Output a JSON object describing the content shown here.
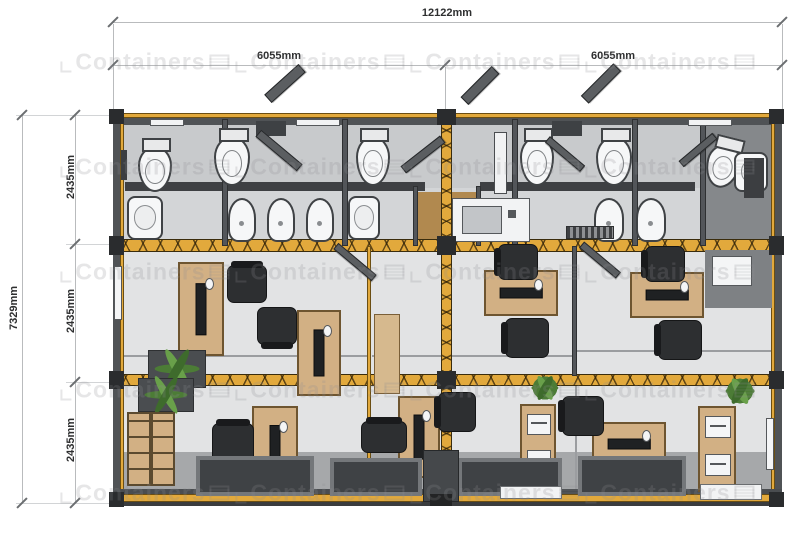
{
  "title": "Container office floor plan",
  "dimensions": {
    "total_width": "12122mm",
    "left_half_width": "6055mm",
    "right_half_width": "6055mm",
    "total_depth": "7329mm",
    "module_depths": [
      "2435mm",
      "2435mm",
      "2435mm"
    ]
  },
  "watermark": {
    "text": "Containers",
    "rows": [
      62,
      167,
      272,
      390,
      493
    ],
    "cols": [
      145,
      320,
      495,
      670
    ]
  },
  "colors": {
    "accent_yellow": "#E2A93C",
    "wall_dark": "#53565A",
    "floor_bath": "#C8CACC",
    "floor_office": "#E2E3E4",
    "walkway_gray": "#A6A8AA",
    "desk_wood": "#D2B084",
    "chair_dark": "#2D2F31",
    "plant_green": "#4C7C36",
    "fixture_white": "#F6F7F8"
  },
  "plan": {
    "items": [
      {
        "t": "rect",
        "n": "floor-bathrooms",
        "x": 119,
        "y": 119,
        "w": 656,
        "h": 127,
        "c": "#C8CACC"
      },
      {
        "t": "rect",
        "n": "floor-bath-corridor",
        "x": 119,
        "y": 188,
        "w": 656,
        "h": 58,
        "c": "#D3D5D7"
      },
      {
        "t": "rect",
        "n": "floor-office-middle",
        "x": 119,
        "y": 246,
        "w": 656,
        "h": 134,
        "c": "#E2E3E4"
      },
      {
        "t": "rect",
        "n": "floor-office-bottom",
        "x": 119,
        "y": 380,
        "w": 656,
        "h": 118,
        "c": "#E2E3E4"
      },
      {
        "t": "rect",
        "n": "floor-walkway",
        "x": 119,
        "y": 452,
        "w": 656,
        "h": 46,
        "c": "#A6A8AA"
      },
      {
        "t": "rect",
        "n": "floor-room-right-dark",
        "x": 703,
        "y": 124,
        "w": 70,
        "h": 116,
        "c": "#85888B"
      },
      {
        "t": "rect",
        "n": "floor-vestibule-wood",
        "x": 416,
        "y": 192,
        "w": 62,
        "h": 54,
        "c": "#B1894F"
      },
      {
        "t": "rect",
        "n": "stall-wall-left",
        "x": 125,
        "y": 182,
        "w": 300,
        "h": 9,
        "c": "#3E4043"
      },
      {
        "t": "rect",
        "n": "stall-wall-right",
        "x": 480,
        "y": 182,
        "w": 215,
        "h": 9,
        "c": "#3E4043"
      },
      {
        "t": "line",
        "n": "glass-line-left",
        "x": 122,
        "y": 355,
        "w": 245,
        "h": 2,
        "c": "#9B9DA0"
      },
      {
        "t": "line",
        "n": "glass-line-center",
        "x": 372,
        "y": 355,
        "w": 200,
        "h": 2,
        "c": "#9B9DA0"
      },
      {
        "t": "line",
        "n": "glass-line-right",
        "x": 577,
        "y": 350,
        "w": 195,
        "h": 2,
        "c": "#9B9DA0"
      },
      {
        "t": "line",
        "n": "glass-line-bottom",
        "x": 575,
        "y": 380,
        "w": 2,
        "h": 116,
        "c": "#9B9DA0"
      },
      {
        "t": "rect",
        "n": "wall-top",
        "x": 113,
        "y": 113,
        "w": 669,
        "h": 12,
        "c": "#505356"
      },
      {
        "t": "yband",
        "n": "frame-top",
        "x": 113,
        "y": 113,
        "w": 669,
        "h": 5
      },
      {
        "t": "rect",
        "n": "wall-left",
        "x": 113,
        "y": 113,
        "w": 7,
        "h": 393,
        "c": "#505356"
      },
      {
        "t": "yband",
        "n": "frame-left",
        "x": 120,
        "y": 118,
        "w": 4,
        "h": 383
      },
      {
        "t": "yband",
        "n": "frame-right",
        "x": 771,
        "y": 118,
        "w": 4,
        "h": 383
      },
      {
        "t": "rect",
        "n": "wall-right",
        "x": 775,
        "y": 113,
        "w": 7,
        "h": 393,
        "c": "#505356"
      },
      {
        "t": "rect",
        "n": "wall-bottom-line",
        "x": 113,
        "y": 489,
        "w": 669,
        "h": 5,
        "c": "#4A4D50"
      },
      {
        "t": "yband",
        "n": "frame-bottom",
        "x": 113,
        "y": 494,
        "w": 669,
        "h": 8
      },
      {
        "t": "rect",
        "n": "wall-bottom-base",
        "x": 113,
        "y": 502,
        "w": 669,
        "h": 4,
        "c": "#3A3C3E"
      },
      {
        "t": "beam",
        "n": "joint-beam-upper",
        "x": 113,
        "y": 239,
        "w": 669,
        "h": 13
      },
      {
        "t": "beam",
        "n": "joint-beam-lower",
        "x": 113,
        "y": 374,
        "w": 669,
        "h": 12
      },
      {
        "t": "beamv",
        "n": "joint-post-center",
        "x": 441,
        "y": 113,
        "w": 11,
        "h": 393
      },
      {
        "t": "wallv",
        "n": "partition-bath-1",
        "x": 222,
        "y": 119,
        "w": 6,
        "h": 127
      },
      {
        "t": "wallv",
        "n": "partition-bath-2",
        "x": 342,
        "y": 119,
        "w": 6,
        "h": 127
      },
      {
        "t": "wallv",
        "n": "partition-bath-3",
        "x": 512,
        "y": 119,
        "w": 6,
        "h": 127
      },
      {
        "t": "wallv",
        "n": "partition-bath-4",
        "x": 632,
        "y": 119,
        "w": 6,
        "h": 127
      },
      {
        "t": "wallv",
        "n": "partition-bath-5",
        "x": 700,
        "y": 119,
        "w": 6,
        "h": 127
      },
      {
        "t": "wallv",
        "n": "vestibule-wall-left",
        "x": 413,
        "y": 186,
        "w": 5,
        "h": 60
      },
      {
        "t": "wallv",
        "n": "vestibule-wall-right",
        "x": 476,
        "y": 186,
        "w": 5,
        "h": 60
      },
      {
        "t": "yband",
        "n": "partition-office-left",
        "x": 367,
        "y": 246,
        "w": 4,
        "h": 250
      },
      {
        "t": "wallv",
        "n": "partition-office-right",
        "x": 572,
        "y": 246,
        "w": 5,
        "h": 130
      },
      {
        "t": "rect",
        "n": "alcove-wall",
        "x": 705,
        "y": 250,
        "w": 67,
        "h": 58,
        "c": "#7E8184"
      },
      {
        "t": "rect",
        "n": "alcove-window",
        "x": 712,
        "y": 256,
        "w": 40,
        "h": 30,
        "c": "#F4F5F6",
        "bd": "#55585B"
      },
      {
        "t": "rect",
        "n": "ledge-1",
        "x": 150,
        "y": 119,
        "w": 34,
        "h": 7,
        "c": "#F2F3F4",
        "bd": "#55585B"
      },
      {
        "t": "rect",
        "n": "ledge-2",
        "x": 296,
        "y": 119,
        "w": 44,
        "h": 7,
        "c": "#F2F3F4",
        "bd": "#55585B"
      },
      {
        "t": "rect",
        "n": "ledge-3",
        "x": 688,
        "y": 119,
        "w": 44,
        "h": 7,
        "c": "#F2F3F4",
        "bd": "#55585B"
      },
      {
        "t": "rect",
        "n": "skylight-1",
        "x": 256,
        "y": 121,
        "w": 30,
        "h": 15,
        "c": "#3E4144"
      },
      {
        "t": "rect",
        "n": "skylight-2",
        "x": 552,
        "y": 121,
        "w": 30,
        "h": 15,
        "c": "#3E4144"
      },
      {
        "t": "slab",
        "n": "door-open-roof-1",
        "x": 262,
        "y": 78,
        "w": 46,
        "h": 11,
        "r": -42
      },
      {
        "t": "slab",
        "n": "door-open-roof-2",
        "x": 458,
        "y": 80,
        "w": 44,
        "h": 11,
        "r": -45
      },
      {
        "t": "slab",
        "n": "door-open-roof-3",
        "x": 578,
        "y": 78,
        "w": 46,
        "h": 11,
        "r": -45
      },
      {
        "t": "toilet",
        "n": "toilet-1",
        "x": 138,
        "y": 146,
        "w": 34,
        "h": 46
      },
      {
        "t": "toilet",
        "n": "toilet-2",
        "x": 214,
        "y": 136,
        "w": 36,
        "h": 50
      },
      {
        "t": "toilet",
        "n": "toilet-3",
        "x": 356,
        "y": 136,
        "w": 34,
        "h": 50
      },
      {
        "t": "toilet",
        "n": "toilet-4",
        "x": 520,
        "y": 136,
        "w": 34,
        "h": 50
      },
      {
        "t": "toilet",
        "n": "toilet-5",
        "x": 596,
        "y": 136,
        "w": 36,
        "h": 50
      },
      {
        "t": "toilet",
        "n": "toilet-6",
        "x": 706,
        "y": 144,
        "w": 34,
        "h": 44,
        "r": 14
      },
      {
        "t": "sink",
        "n": "sink-1",
        "x": 127,
        "y": 196,
        "w": 36,
        "h": 44
      },
      {
        "t": "sink",
        "n": "sink-2",
        "x": 348,
        "y": 196,
        "w": 32,
        "h": 44
      },
      {
        "t": "sink",
        "n": "sink-3",
        "x": 734,
        "y": 152,
        "w": 34,
        "h": 40
      },
      {
        "t": "urinal",
        "n": "urinal-1",
        "x": 228,
        "y": 198,
        "w": 28,
        "h": 44
      },
      {
        "t": "urinal",
        "n": "urinal-2",
        "x": 267,
        "y": 198,
        "w": 28,
        "h": 44
      },
      {
        "t": "urinal",
        "n": "urinal-3",
        "x": 306,
        "y": 198,
        "w": 28,
        "h": 44
      },
      {
        "t": "urinal",
        "n": "urinal-4",
        "x": 594,
        "y": 198,
        "w": 30,
        "h": 44
      },
      {
        "t": "urinal",
        "n": "urinal-5",
        "x": 636,
        "y": 198,
        "w": 30,
        "h": 44
      },
      {
        "t": "rect",
        "n": "kitchenette-counter",
        "x": 452,
        "y": 198,
        "w": 78,
        "h": 44,
        "c": "#F2F3F4",
        "bd": "#55585B"
      },
      {
        "t": "rect",
        "n": "kitchenette-sink",
        "x": 462,
        "y": 206,
        "w": 40,
        "h": 28,
        "c": "#C2C5C8",
        "bd": "#55585B"
      },
      {
        "t": "rect",
        "n": "kitchenette-faucet",
        "x": 508,
        "y": 210,
        "w": 8,
        "h": 8,
        "c": "#55585B"
      },
      {
        "t": "rect",
        "n": "cabinet-white-tall",
        "x": 494,
        "y": 132,
        "w": 13,
        "h": 62,
        "c": "#F1F2F3",
        "bd": "#4A4D50"
      },
      {
        "t": "rect",
        "n": "locker-dark",
        "x": 744,
        "y": 158,
        "w": 20,
        "h": 40,
        "c": "#3C3E41"
      },
      {
        "t": "grate",
        "n": "floor-grate",
        "x": 566,
        "y": 226,
        "w": 48,
        "h": 13
      },
      {
        "t": "rect",
        "n": "mirror",
        "x": 121,
        "y": 150,
        "w": 6,
        "h": 30,
        "c": "#3C3E41"
      },
      {
        "t": "slab",
        "n": "door-open-bath-1",
        "x": 252,
        "y": 146,
        "w": 54,
        "h": 9,
        "r": 40
      },
      {
        "t": "slab",
        "n": "door-open-bath-2",
        "x": 398,
        "y": 150,
        "w": 50,
        "h": 9,
        "r": -38
      },
      {
        "t": "slab",
        "n": "door-open-bath-3",
        "x": 542,
        "y": 150,
        "w": 46,
        "h": 8,
        "r": 40
      },
      {
        "t": "slab",
        "n": "door-open-bath-4",
        "x": 676,
        "y": 146,
        "w": 44,
        "h": 8,
        "r": -40
      },
      {
        "t": "rect",
        "n": "window-left-wall",
        "x": 114,
        "y": 266,
        "w": 8,
        "h": 54,
        "c": "#F4F5F6",
        "bd": "#55585B"
      },
      {
        "t": "desk",
        "n": "desk-1",
        "x": 178,
        "y": 262,
        "w": 46,
        "h": 94
      },
      {
        "t": "chair",
        "n": "chair-1",
        "x": 228,
        "y": 264,
        "w": 38,
        "h": 40,
        "r": 90
      },
      {
        "t": "chair",
        "n": "chair-2",
        "x": 258,
        "y": 306,
        "w": 38,
        "h": 40,
        "r": -90
      },
      {
        "t": "desk",
        "n": "desk-2",
        "x": 297,
        "y": 310,
        "w": 44,
        "h": 86
      },
      {
        "t": "planter",
        "n": "planter-middle-left",
        "x": 148,
        "y": 350,
        "w": 58,
        "h": 38
      },
      {
        "t": "desk",
        "n": "desk-3",
        "x": 484,
        "y": 270,
        "w": 74,
        "h": 46
      },
      {
        "t": "chair",
        "n": "chair-3",
        "x": 498,
        "y": 244,
        "w": 40,
        "h": 36
      },
      {
        "t": "chair",
        "n": "chair-4",
        "x": 505,
        "y": 318,
        "w": 44,
        "h": 40
      },
      {
        "t": "rect",
        "n": "cabinet-tall-wood",
        "x": 374,
        "y": 314,
        "w": 26,
        "h": 80,
        "c": "#D6B98E",
        "bd": "#7A5F38"
      },
      {
        "t": "desk",
        "n": "desk-4",
        "x": 630,
        "y": 272,
        "w": 74,
        "h": 46
      },
      {
        "t": "chair",
        "n": "chair-5",
        "x": 645,
        "y": 246,
        "w": 40,
        "h": 36
      },
      {
        "t": "chair",
        "n": "chair-6",
        "x": 658,
        "y": 320,
        "w": 44,
        "h": 40
      },
      {
        "t": "slab",
        "n": "door-open-office-1",
        "x": 330,
        "y": 258,
        "w": 50,
        "h": 8,
        "r": 40
      },
      {
        "t": "slab",
        "n": "door-open-office-2",
        "x": 576,
        "y": 256,
        "w": 48,
        "h": 8,
        "r": 40
      },
      {
        "t": "planter",
        "n": "planter-bottom-left",
        "x": 138,
        "y": 378,
        "w": 56,
        "h": 34
      },
      {
        "t": "shelf",
        "n": "bookshelf",
        "x": 127,
        "y": 412,
        "w": 48,
        "h": 74
      },
      {
        "t": "desk",
        "n": "desk-5",
        "x": 252,
        "y": 406,
        "w": 46,
        "h": 84
      },
      {
        "t": "chair",
        "n": "chair-7",
        "x": 213,
        "y": 422,
        "w": 40,
        "h": 42,
        "r": 90
      },
      {
        "t": "desk",
        "n": "desk-6",
        "x": 398,
        "y": 396,
        "w": 42,
        "h": 82
      },
      {
        "t": "chair",
        "n": "chair-8",
        "x": 368,
        "y": 414,
        "w": 32,
        "h": 46,
        "r": 90
      },
      {
        "t": "chair",
        "n": "chair-9",
        "x": 438,
        "y": 392,
        "w": 38,
        "h": 40
      },
      {
        "t": "cab",
        "n": "cabinet-printer-center",
        "x": 520,
        "y": 404,
        "w": 36,
        "h": 82
      },
      {
        "t": "plant",
        "n": "plant-center",
        "x": 528,
        "y": 372,
        "w": 34,
        "h": 32
      },
      {
        "t": "desk",
        "n": "desk-7",
        "x": 592,
        "y": 422,
        "w": 74,
        "h": 44
      },
      {
        "t": "chair",
        "n": "chair-10",
        "x": 562,
        "y": 396,
        "w": 42,
        "h": 40
      },
      {
        "t": "cab",
        "n": "cabinet-printer-right",
        "x": 698,
        "y": 406,
        "w": 38,
        "h": 86
      },
      {
        "t": "plant",
        "n": "plant-right",
        "x": 722,
        "y": 374,
        "w": 36,
        "h": 34
      },
      {
        "t": "rect",
        "n": "window-right-wall",
        "x": 766,
        "y": 418,
        "w": 8,
        "h": 52,
        "c": "#F4F5F6",
        "bd": "#55585B"
      },
      {
        "t": "mat",
        "n": "entry-mat-1",
        "x": 196,
        "y": 456,
        "w": 118,
        "h": 40
      },
      {
        "t": "mat",
        "n": "entry-mat-2",
        "x": 330,
        "y": 458,
        "w": 92,
        "h": 38
      },
      {
        "t": "mat",
        "n": "entry-mat-3",
        "x": 458,
        "y": 458,
        "w": 104,
        "h": 38
      },
      {
        "t": "mat",
        "n": "entry-mat-4",
        "x": 578,
        "y": 456,
        "w": 108,
        "h": 40
      },
      {
        "t": "rect",
        "n": "threshold-white-1",
        "x": 500,
        "y": 486,
        "w": 62,
        "h": 13,
        "c": "#F2F3F4",
        "bd": "#6A6D70"
      },
      {
        "t": "rect",
        "n": "threshold-white-2",
        "x": 700,
        "y": 484,
        "w": 62,
        "h": 16,
        "c": "#F2F3F4",
        "bd": "#6A6D70"
      },
      {
        "t": "rect",
        "n": "entry-door-center",
        "x": 423,
        "y": 450,
        "w": 36,
        "h": 52,
        "c": "#45484B",
        "bd": "#26282A"
      },
      {
        "t": "rect",
        "n": "entry-door-step",
        "x": 430,
        "y": 494,
        "w": 22,
        "h": 12,
        "c": "#232425"
      },
      {
        "t": "rect",
        "n": "corner-block-tl",
        "x": 109,
        "y": 109,
        "w": 15,
        "h": 15,
        "c": "#2A2C2E"
      },
      {
        "t": "rect",
        "n": "corner-block-tr",
        "x": 769,
        "y": 109,
        "w": 15,
        "h": 15,
        "c": "#2A2C2E"
      },
      {
        "t": "rect",
        "n": "corner-block-bl",
        "x": 109,
        "y": 492,
        "w": 15,
        "h": 15,
        "c": "#2A2C2E"
      },
      {
        "t": "rect",
        "n": "corner-block-br",
        "x": 769,
        "y": 492,
        "w": 15,
        "h": 15,
        "c": "#2A2C2E"
      },
      {
        "t": "rect",
        "n": "connector-top-center",
        "x": 437,
        "y": 109,
        "w": 19,
        "h": 16,
        "c": "#2A2C2E"
      },
      {
        "t": "rect",
        "n": "connector-mid-left",
        "x": 109,
        "y": 236,
        "w": 15,
        "h": 19,
        "c": "#2A2C2E"
      },
      {
        "t": "rect",
        "n": "connector-mid-center",
        "x": 437,
        "y": 236,
        "w": 19,
        "h": 19,
        "c": "#2A2C2E"
      },
      {
        "t": "rect",
        "n": "connector-mid-right",
        "x": 769,
        "y": 236,
        "w": 15,
        "h": 19,
        "c": "#2A2C2E"
      },
      {
        "t": "rect",
        "n": "connector-low-left",
        "x": 109,
        "y": 371,
        "w": 15,
        "h": 18,
        "c": "#2A2C2E"
      },
      {
        "t": "rect",
        "n": "connector-low-center",
        "x": 437,
        "y": 371,
        "w": 19,
        "h": 18,
        "c": "#2A2C2E"
      },
      {
        "t": "rect",
        "n": "connector-low-right",
        "x": 769,
        "y": 371,
        "w": 15,
        "h": 18,
        "c": "#2A2C2E"
      }
    ]
  }
}
